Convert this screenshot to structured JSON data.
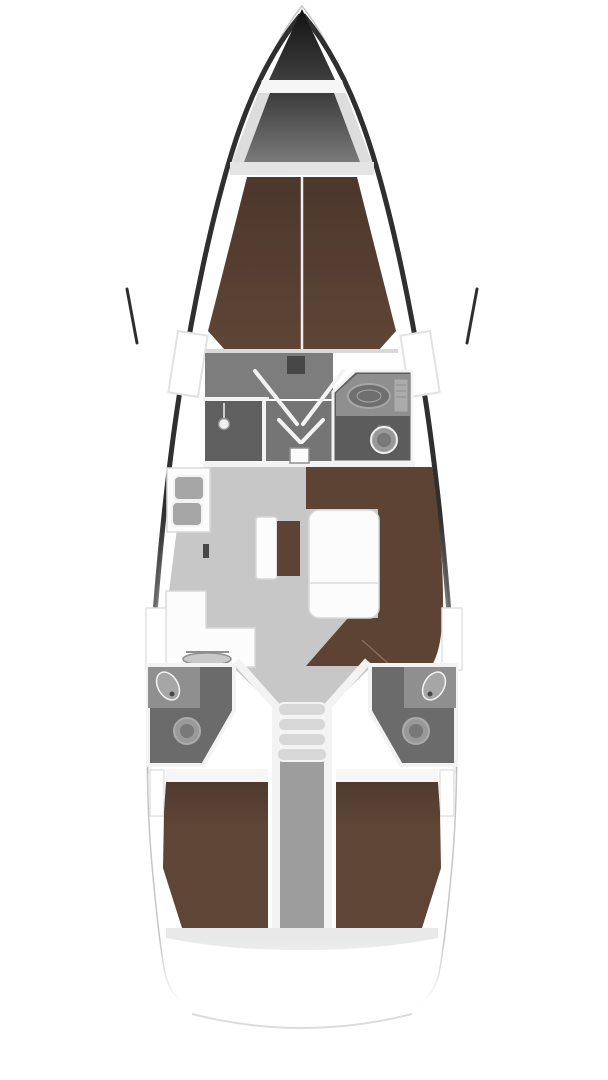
{
  "diagram": {
    "type": "yacht-interior-floor-plan",
    "view": "top-down, bow-up",
    "areas": [
      {
        "id": "anchor-locker",
        "label": "anchor locker"
      },
      {
        "id": "forward-cabin",
        "label": "forward cabin with V-berth"
      },
      {
        "id": "forward-shower",
        "label": "forward shower compartment"
      },
      {
        "id": "forward-head",
        "label": "forward head with sink and toilet"
      },
      {
        "id": "salon",
        "label": "salon"
      },
      {
        "id": "galley",
        "label": "galley with double sink and stove"
      },
      {
        "id": "settee",
        "label": "U-shaped settee with table"
      },
      {
        "id": "companionway",
        "label": "companionway steps"
      },
      {
        "id": "aft-head-port",
        "label": "aft head port side"
      },
      {
        "id": "aft-head-starboard",
        "label": "aft head starboard side"
      },
      {
        "id": "aft-cabin-port",
        "label": "aft cabin port with double berth"
      },
      {
        "id": "aft-cabin-starboard",
        "label": "aft cabin starboard with double berth"
      },
      {
        "id": "engine-compartment",
        "label": "engine compartment under steps"
      }
    ]
  },
  "colors": {
    "background": "#ffffff",
    "hull_outline": "#c6c6c6",
    "hull_dark": "#2f2f2f",
    "bow_dark_top": "#121212",
    "bow_dark_bottom": "#555555",
    "locker_inner_top": "#3c3c3c",
    "locker_inner_bottom": "#7a7a7a",
    "locker_wall": "#dddddd",
    "deck_beam": "#e4e4e4",
    "deck_white": "#f6f6f6",
    "window_white": "#ffffff",
    "window_stroke": "#e2e2e2",
    "berth_brown": "#5e4536",
    "berth_brown_dark": "#4c372c",
    "settee_brown": "#5d4333",
    "settee_seam": "#8a6a55",
    "floor_forward": "#7d7d7d",
    "floor_shower": "#5f5f5f",
    "floor_passage": "#757575",
    "floor_salon": "#c7c7c7",
    "head_floor": "#6b6b6b",
    "head_floor_fwd": "#5c5c5c",
    "counter_gray": "#8f8f8f",
    "sink_gray": "#a6a6a6",
    "sink_inner": "#6f6f6f",
    "toilet_gray": "#999999",
    "toilet_inner": "#787878",
    "panel_gray": "#ababab",
    "wall_white": "#f3f3f3",
    "wall_edge": "#d9d9d9",
    "furniture_white": "#fcfcfc",
    "furniture_stroke": "#d8d8d8",
    "table_seam": "#e4e4e4",
    "steps_gray": "#d7d7d7",
    "engine_gray": "#9d9d9d",
    "deck_strip": "#e9e9e9",
    "transom_line": "#dcdcdc",
    "seam_white": "#f0f0f0",
    "dark_accent": "#474747",
    "stove_gray": "#c9c9c9",
    "stove_stroke": "#8f8f8f"
  }
}
